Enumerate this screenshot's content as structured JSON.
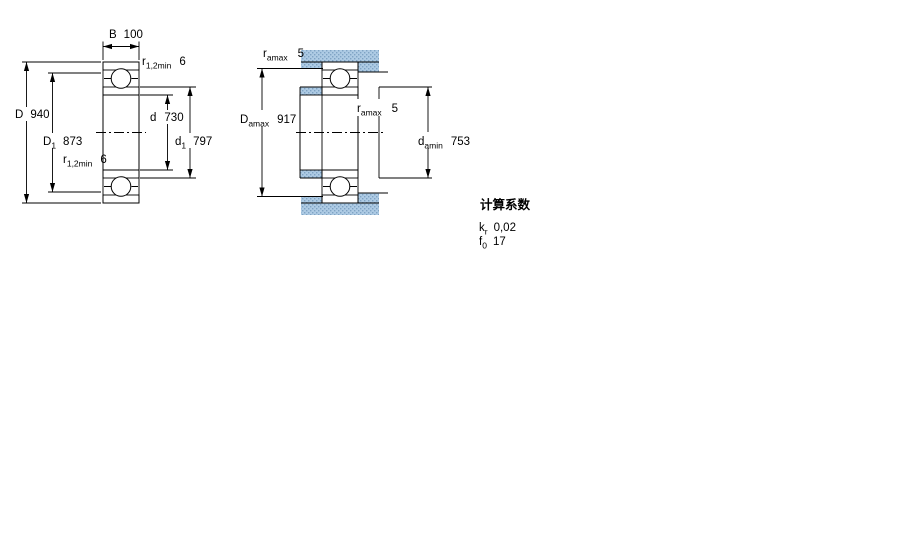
{
  "drawing": {
    "type": "bearing-cross-section-technical-drawing",
    "left_diagram": {
      "b": {
        "main": "B",
        "value": "100"
      },
      "r_top": {
        "main": "r",
        "sub": "1,2min",
        "value": "6"
      },
      "D": {
        "main": "D",
        "value": "940"
      },
      "D1": {
        "main": "D",
        "sub": "1",
        "value": "873"
      },
      "r_bottom": {
        "main": "r",
        "sub": "1,2min",
        "value": "6"
      },
      "d": {
        "main": "d",
        "value": "730"
      },
      "d1": {
        "main": "d",
        "sub": "1",
        "value": "797"
      }
    },
    "right_diagram": {
      "r_a_top": {
        "main": "r",
        "sub": "amax",
        "value": "5"
      },
      "D_amax": {
        "main": "D",
        "sub": "amax",
        "value": "917"
      },
      "r_a_mid": {
        "main": "r",
        "sub": "amax",
        "value": "5"
      },
      "d_amin": {
        "main": "d",
        "sub": "amin",
        "value": "753"
      }
    },
    "calculation_factors": {
      "title": "计算系数",
      "kr": {
        "main": "k",
        "sub": "r",
        "value": "0,02"
      },
      "f0": {
        "main": "f",
        "sub": "0",
        "value": "17"
      }
    },
    "colors": {
      "hatch_base": "#aecbe4",
      "hatch_dot": "#7fa3c4",
      "line": "#000000",
      "background": "#ffffff"
    }
  }
}
